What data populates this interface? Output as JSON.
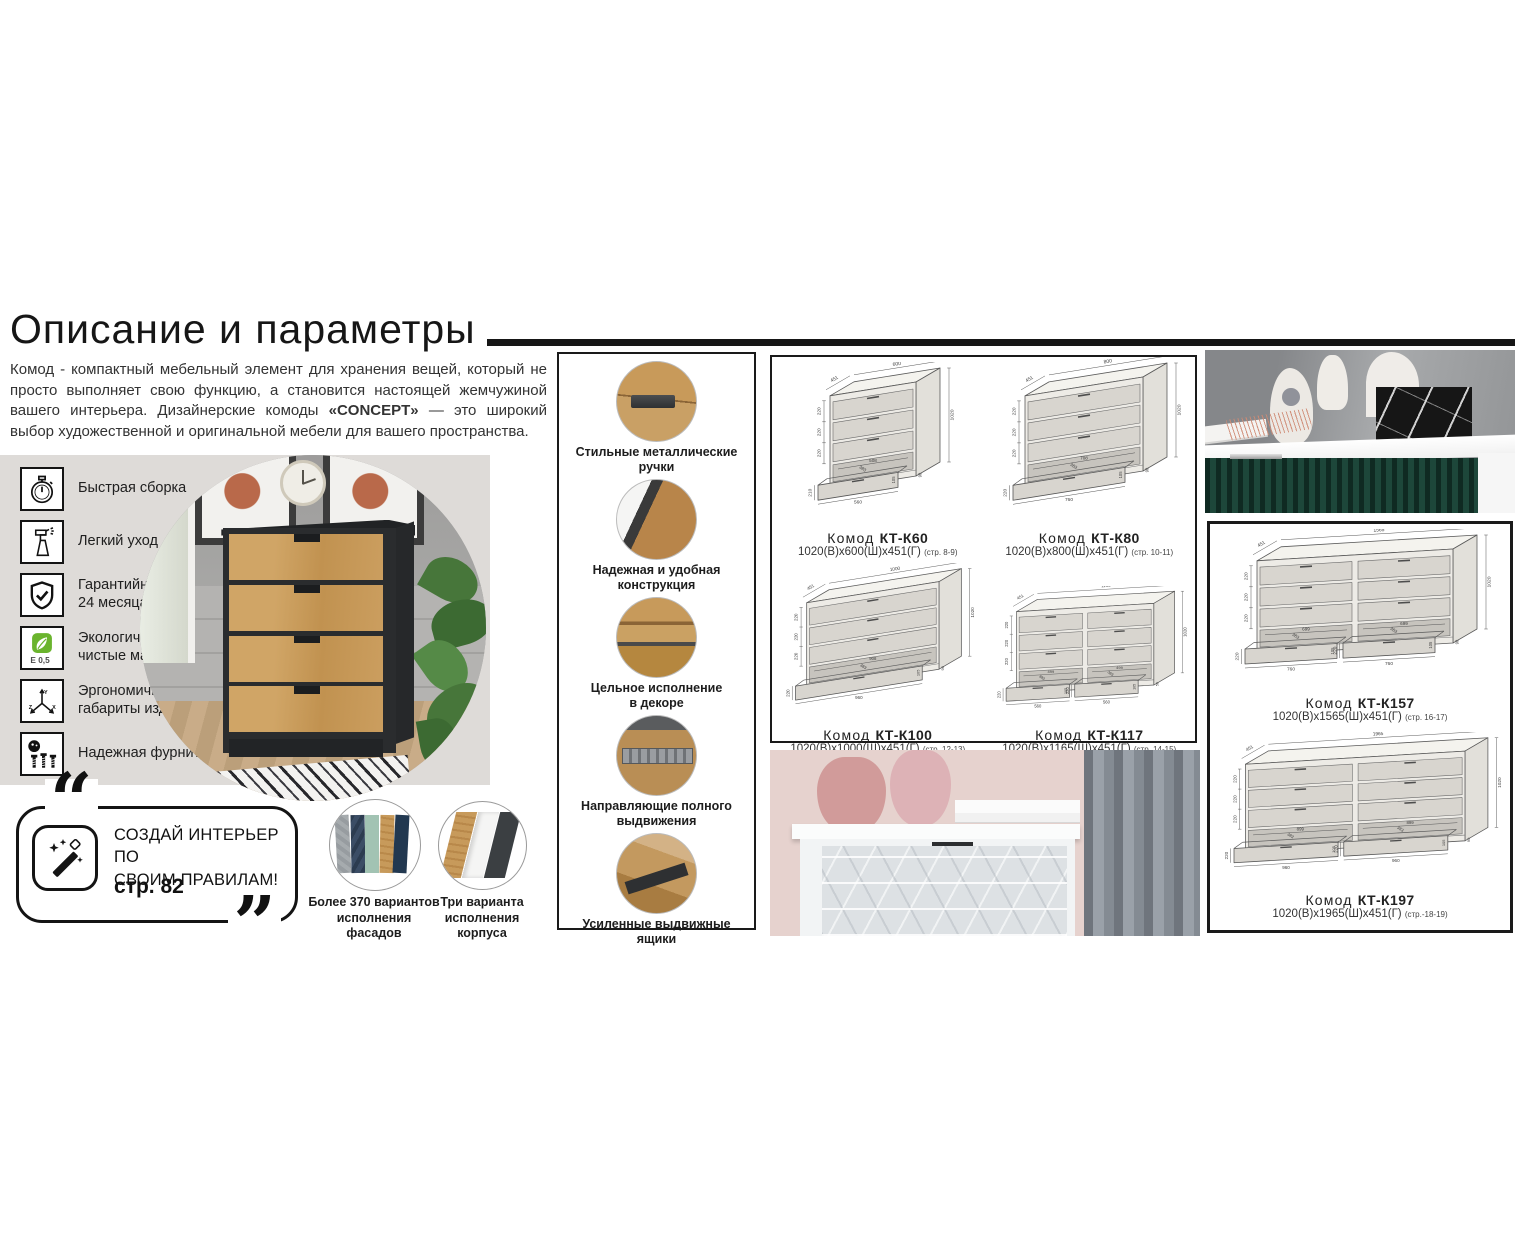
{
  "header": {
    "title": "Описание и параметры"
  },
  "intro": {
    "part1": "Комод - компактный мебельный элемент для хранения вещей, который не просто выполняет свою функцию, а становится настоящей жемчужиной вашего интерьера. Дизайнерские комоды ",
    "brand": "«CONCEPT»",
    "part2": " — это широкий выбор художественной и оригинальной мебели для вашего пространства."
  },
  "features": [
    {
      "icon": "stopwatch-icon",
      "label": "Быстрая сборка"
    },
    {
      "icon": "spray-bottle-icon",
      "label": "Легкий уход"
    },
    {
      "icon": "shield-check-icon",
      "label": "Гарантийный срок\n24 месяца"
    },
    {
      "icon": "eco-leaf-icon",
      "label": "Экологически\nчистые материалы"
    },
    {
      "icon": "xyz-axes-icon",
      "label": "Эргономичные\nгабариты изделий"
    },
    {
      "icon": "fittings-icon",
      "label": "Надежная фурнитура"
    }
  ],
  "promo": {
    "quote_open": "“",
    "quote_close": "”",
    "icon": "magic-wand-icon",
    "lines": "СОЗДАЙ ИНТЕРЬЕР ПО\nСВОИМ ПРАВИЛАМ!",
    "page_ref": "стр. 82"
  },
  "variants": [
    {
      "caption": "Более 370 вариантов\nисполнения фасадов"
    },
    {
      "caption": "Три варианта\nисполнения корпуса"
    }
  ],
  "details": [
    {
      "caption": "Стильные металлические\nручки"
    },
    {
      "caption": "Надежная и удобная\nконструкция"
    },
    {
      "caption": "Цельное исполнение\nв декоре"
    },
    {
      "caption": "Направляющие полного\nвыдвижения"
    },
    {
      "caption": "Усиленные выдвижные\nящики"
    }
  ],
  "models": [
    {
      "label_prefix": "Комод",
      "code": "КТ-К60",
      "dims": "1020(В)x600(Ш)x451(Г)",
      "pages": "(стр. 8-9)",
      "top_width": "600",
      "depth": "451",
      "height": "1020",
      "drawer_heights": [
        "220",
        "220",
        "220"
      ],
      "inner_widths": [
        "508"
      ],
      "front_widths": [
        "560"
      ],
      "front_height": "210",
      "drawer_depth": "383",
      "drawer_inner_height": "105",
      "plinth_height": "90",
      "cols": 1,
      "px": 86,
      "maxw": 210
    },
    {
      "label_prefix": "Комод",
      "code": "КТ-К80",
      "dims": "1020(В)x800(Ш)x451(Г)",
      "pages": "(стр. 10-11)",
      "top_width": "800",
      "depth": "451",
      "height": "1020",
      "drawer_heights": [
        "220",
        "220",
        "220"
      ],
      "inner_widths": [
        "708"
      ],
      "front_widths": [
        "760"
      ],
      "front_height": "220",
      "drawer_depth": "383",
      "drawer_inner_height": "105",
      "plinth_height": "90",
      "cols": 1,
      "px": 118,
      "maxw": 210
    },
    {
      "label_prefix": "Комод",
      "code": "КТ-К100",
      "dims": "1020(В)x1000(Ш)x451(Г)",
      "pages": "(стр. 12-13)",
      "top_width": "1000",
      "depth": "451",
      "height": "1020",
      "drawer_heights": [
        "220",
        "220",
        "220"
      ],
      "inner_widths": [
        "908"
      ],
      "front_widths": [
        "960"
      ],
      "front_height": "220",
      "drawer_depth": "383",
      "drawer_inner_height": "105",
      "plinth_height": "90",
      "cols": 1,
      "px": 142,
      "maxw": 205
    },
    {
      "label_prefix": "Комод",
      "code": "КТ-К117",
      "dims": "1020(В)x1165(Ш)x451(Г)",
      "pages": "(стр. 14-15)",
      "top_width": "1165",
      "depth": "451",
      "height": "1020",
      "drawer_heights": [
        "220",
        "220",
        "220"
      ],
      "inner_widths": [
        "499",
        "499"
      ],
      "front_widths": [
        "560",
        "560"
      ],
      "front_height": "220",
      "drawer_depth": "383",
      "drawer_inner_height": "105",
      "plinth_height": "50",
      "cols": 2,
      "px": 158,
      "maxw": 205
    },
    {
      "label_prefix": "Комод",
      "code": "КТ-К157",
      "dims": "1020(В)x1565(Ш)x451(Г)",
      "pages": "(стр. 16-17)",
      "top_width": "1565",
      "depth": "451",
      "height": "1020",
      "drawer_heights": [
        "220",
        "220",
        "220"
      ],
      "inner_widths": [
        "699",
        "699"
      ],
      "front_widths": [
        "760",
        "760"
      ],
      "front_height": "220",
      "drawer_depth": "383",
      "drawer_inner_height": "105",
      "plinth_height": "90",
      "cols": 2,
      "px": 196,
      "maxw": 294
    },
    {
      "label_prefix": "Комод",
      "code": "КТ-К197",
      "dims": "1020(В)x1965(Ш)x451(Г)",
      "pages": "(стр.-18-19)",
      "top_width": "1965",
      "depth": "451",
      "height": "1020",
      "drawer_heights": [
        "220",
        "220",
        "220"
      ],
      "inner_widths": [
        "899",
        "899"
      ],
      "front_widths": [
        "960",
        "960"
      ],
      "front_height": "220",
      "drawer_depth": "383",
      "drawer_inner_height": "105",
      "plinth_height": "90",
      "cols": 2,
      "px": 230,
      "maxw": 294
    }
  ],
  "colors": {
    "accent_black": "#161616",
    "panel_gray": "#dedbd8",
    "oak": "#c79a5b",
    "dark_green": "#1d473a",
    "eco_green": "#6ab42d"
  }
}
